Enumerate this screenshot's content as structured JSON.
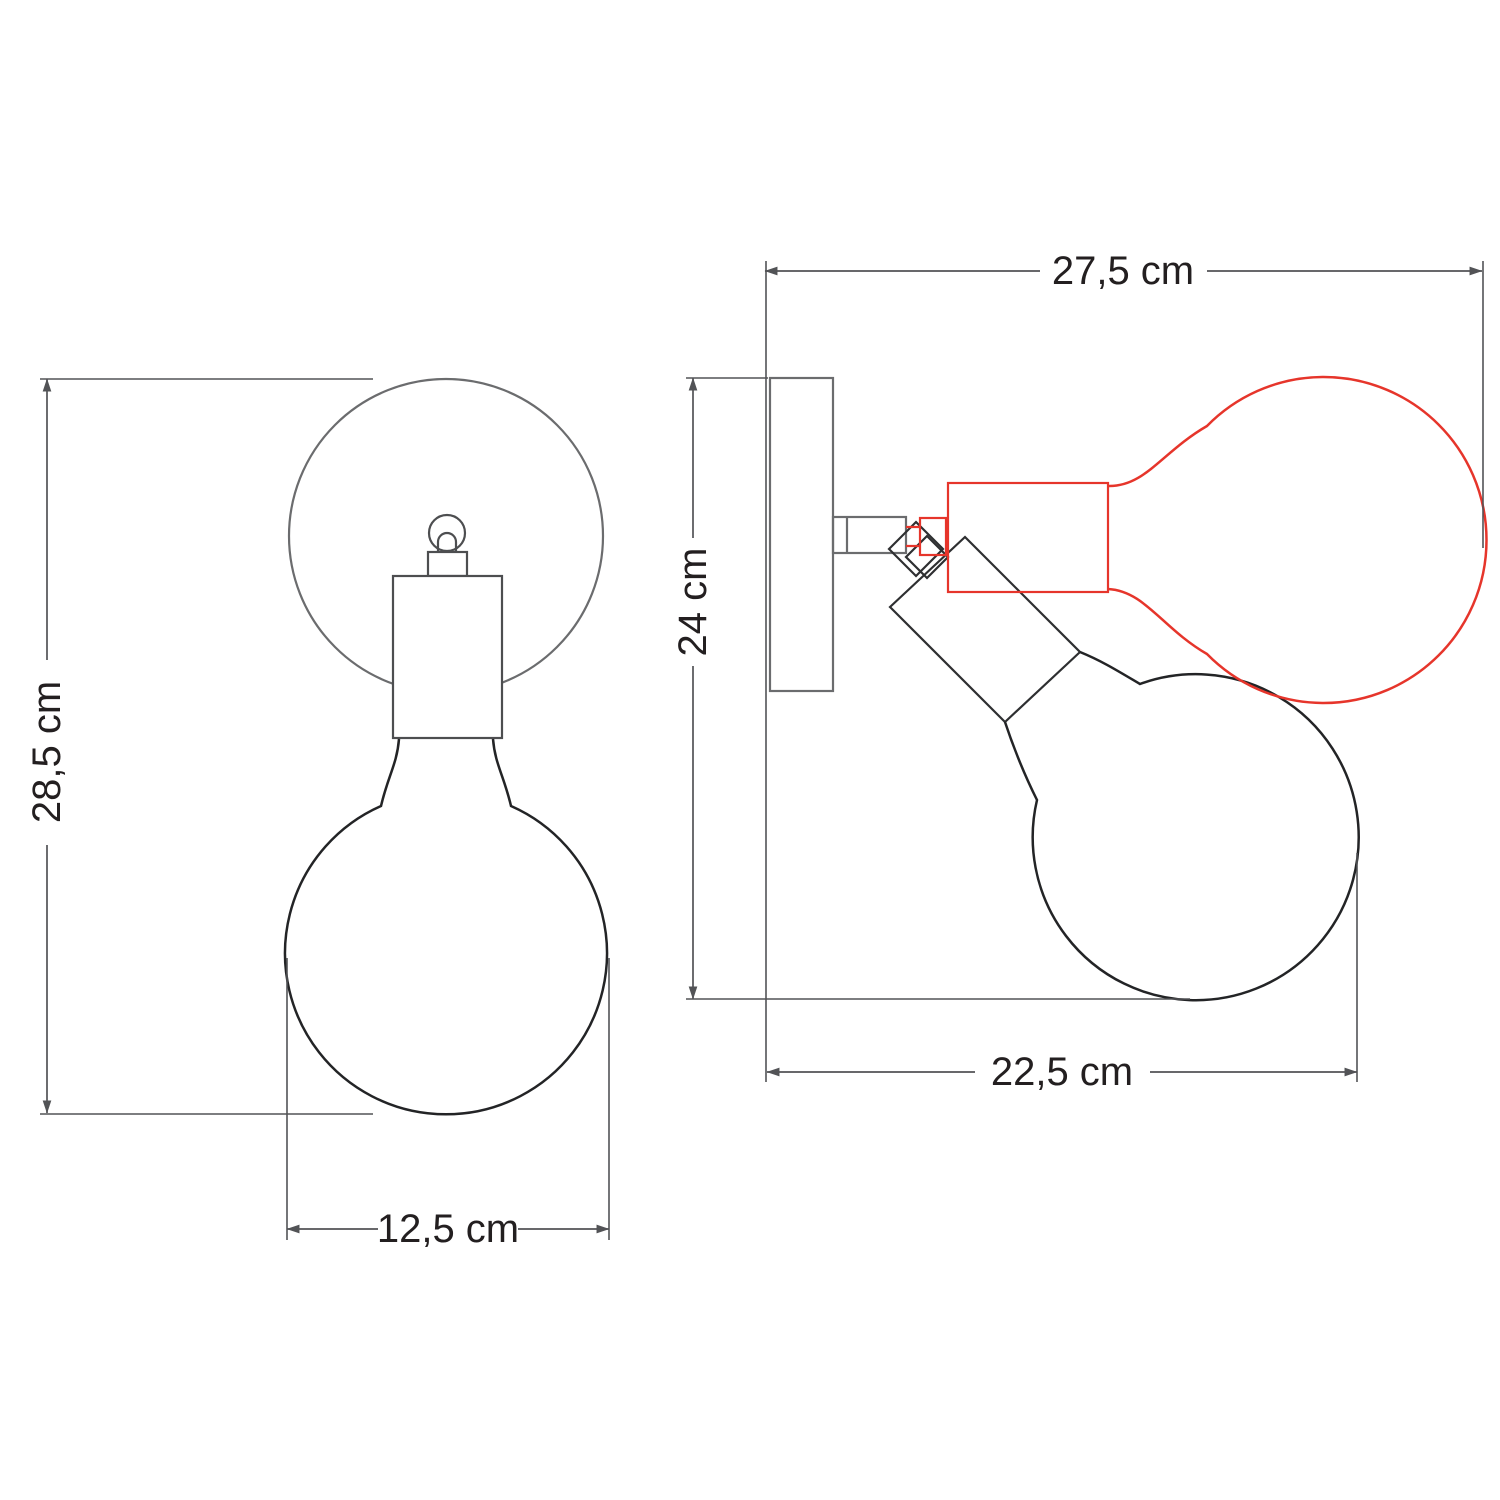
{
  "diagram": {
    "type": "technical dimension drawing",
    "subject": "adjustable wall lamp with globe bulb, front and side views",
    "views": {
      "front": {
        "name": "front view",
        "height": {
          "label": "28,5 cm",
          "value_cm": 28.5
        },
        "width": {
          "label": "12,5 cm",
          "value_cm": 12.5
        }
      },
      "side": {
        "name": "side view",
        "top_width": {
          "label": "27,5 cm",
          "value_cm": 27.5
        },
        "height": {
          "label": "24 cm",
          "value_cm": 24
        },
        "bottom_width": {
          "label": "22,5 cm",
          "value_cm": 22.5
        }
      }
    },
    "legend": {
      "black_outline": "lamp in straight/downward position",
      "red_outline": "alternative tilted position of socket and bulb"
    }
  },
  "colors": {
    "background": "#ffffff",
    "dimension": "#525356",
    "label_text": "#231f20",
    "plate_gray": "#6b6c6e",
    "part_gray": "#4d4e50",
    "drawing_dark": "#2e2f31",
    "bulb_dark": "#232426",
    "accent_red": "#e6352b"
  }
}
